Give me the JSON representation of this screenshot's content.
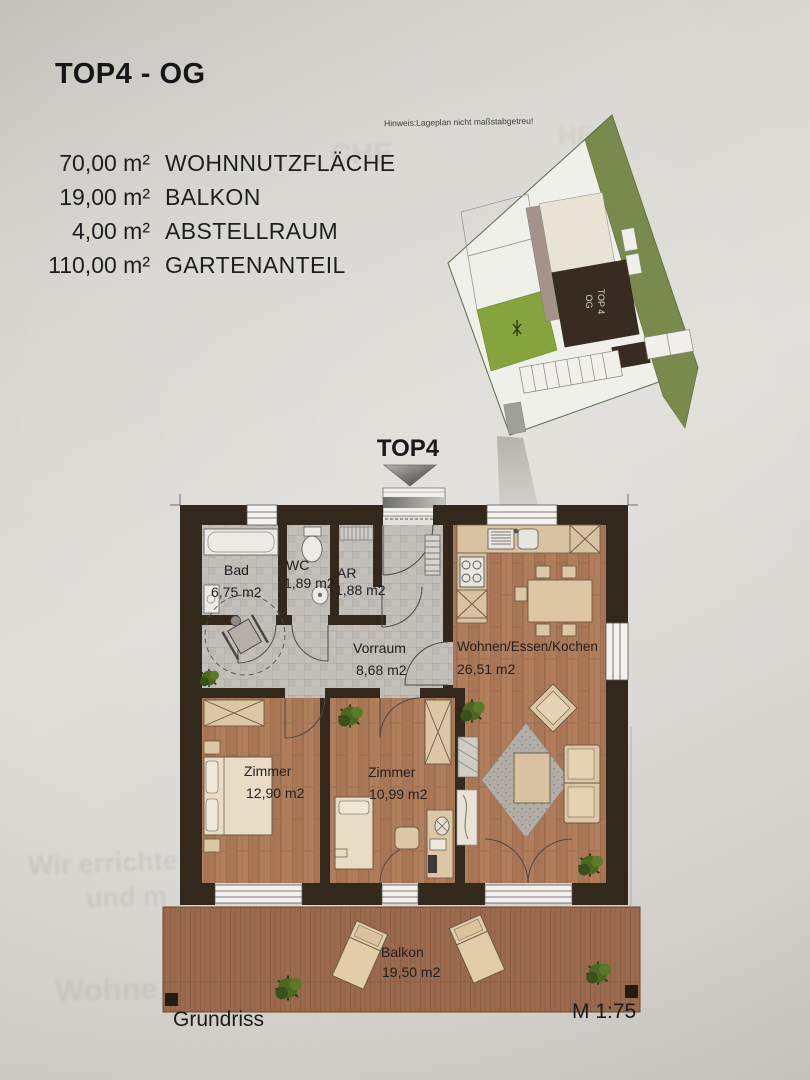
{
  "page": {
    "title": "TOP4 - OG"
  },
  "stats": {
    "items": [
      {
        "value": "70,00 m²",
        "label": "WOHNNUTZFLÄCHE"
      },
      {
        "value": "19,00 m²",
        "label": "BALKON"
      },
      {
        "value": "4,00 m²",
        "label": "ABSTELLRAUM"
      },
      {
        "value": "110,00 m²",
        "label": "GARTENANTEIL"
      }
    ]
  },
  "siteplan": {
    "hint": "Hinweis:Lageplan nicht maßstabgetreu!",
    "building_line1": "TOP 4",
    "building_line2": "OG"
  },
  "pointer": {
    "label": "TOP4"
  },
  "rooms": {
    "bad": {
      "name": "Bad",
      "area": "6,75 m2"
    },
    "wc": {
      "name": "WC",
      "area": "1,89 m2"
    },
    "ar": {
      "name": "AR",
      "area": "1,88 m2"
    },
    "vorraum": {
      "name": "Vorraum",
      "area": "8,68 m2"
    },
    "wohnen": {
      "name": "Wohnen/Essen/Kochen",
      "area": "26,51 m2"
    },
    "zimmer1": {
      "name": "Zimmer",
      "area": "12,90 m2"
    },
    "zimmer2": {
      "name": "Zimmer",
      "area": "10,99 m2"
    },
    "balkon": {
      "name": "Balkon",
      "area": "19,50 m2"
    }
  },
  "footer": {
    "caption": "Grundriss",
    "scale": "M 1:75"
  },
  "ghost_bleedthrough": {
    "top1": "CHE",
    "top2": "HE",
    "line1": "Wir errichte",
    "line2": "und m",
    "line3": "Wohne"
  },
  "colors": {
    "wall": "#33281c",
    "wood_floor": "#b17e5b",
    "tile_floor": "#c3c0ba",
    "deck": "#9b6a4d",
    "furniture": "#dcc6a4",
    "site_green_strip": "#7a8a4c",
    "site_green_garden": "#86a43e",
    "site_building_dark": "#372b22",
    "paper": "#d8d6d1"
  }
}
